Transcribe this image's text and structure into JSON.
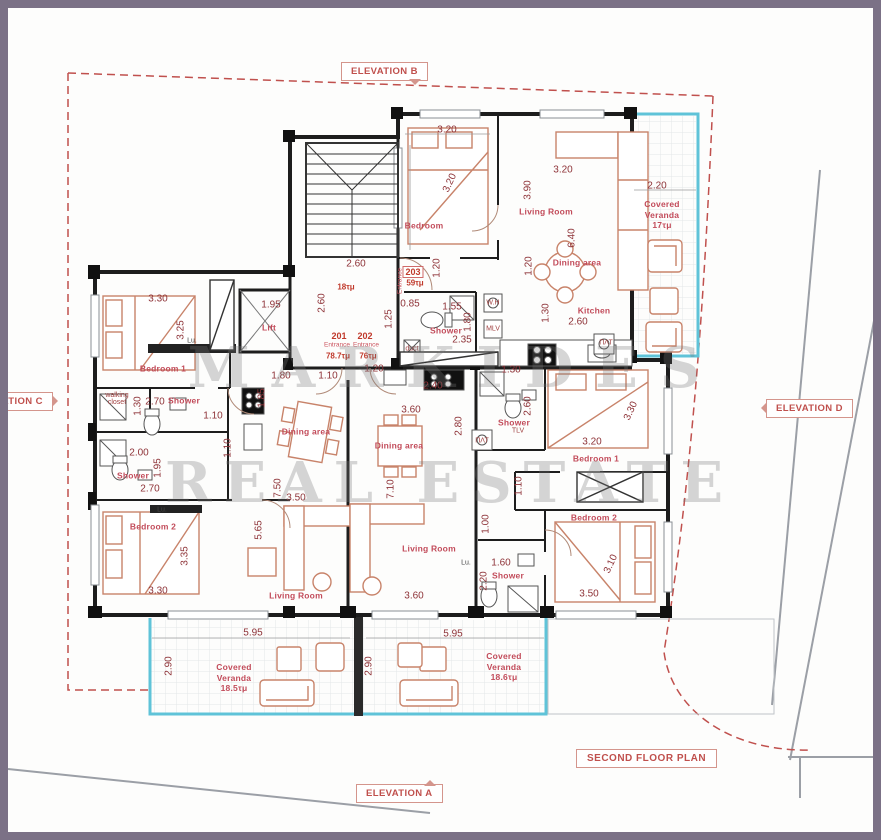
{
  "plan_title": "SECOND FLOOR PLAN",
  "elevations": {
    "a": "ELEVATION A",
    "b": "ELEVATION B",
    "c": "ELEVATION C",
    "d": "ELEVATION D"
  },
  "watermark": {
    "line1": "MARKIDES",
    "line2": "REAL ESTATE"
  },
  "units": {
    "u201": {
      "number": "201",
      "entrance": "Entrance",
      "area": "78.7τμ"
    },
    "u202": {
      "number": "202",
      "entrance": "Entrance",
      "area": "76τμ"
    },
    "u203": {
      "number": "203",
      "entrance": "Entrance",
      "area": "59τμ"
    },
    "landing_area": "18τμ"
  },
  "rooms": [
    "Bedroom",
    "Living Room",
    "Dining area",
    "Kitchen",
    "Covered\nVeranda\n17τμ",
    "Shower",
    "Lift",
    "Bedroom 1",
    "Shower",
    "Shower",
    "Bedroom 2",
    "Living Room",
    "Dining area",
    "Dining area",
    "Living Room",
    "Bedroom 1",
    "Shower",
    "Bedroom 2",
    "Shower",
    "Covered\nVeranda\n18.5τμ",
    "Covered\nVeranda\n18.6τμ"
  ],
  "dims": [
    "3.20",
    "3.20",
    "3.20",
    "3.90",
    "6.40",
    "2.20",
    "1.20",
    "1.30",
    "2.60",
    "0.85",
    "1.25",
    "1.55",
    "1.80",
    "2.35",
    "1.20",
    "2.60",
    "2.60",
    "1.95",
    "1.85",
    "1.10",
    "3.30",
    "3.25",
    "2.70",
    "1.30",
    "2.00",
    "1.95",
    "2.70",
    "1.10",
    "3.35",
    "3.30",
    "5.65",
    "7.50",
    "3.50",
    "1.80",
    "1.10",
    "1.20",
    "2.40",
    "3.60",
    "2.80",
    "7.10",
    "3.60",
    "1.30",
    "2.60",
    "3.30",
    "3.20",
    "1.10",
    "1.00",
    "1.60",
    "2.20",
    "3.10",
    "3.50",
    "5.95",
    "2.90",
    "2.90",
    "5.95"
  ],
  "small_labels": [
    "ΠΛΤ",
    "duct",
    "W.H",
    "MLV",
    "TLV",
    "ΠΛΤ",
    "Lu.",
    "Lu.",
    "Lu.",
    "walking\ncloset"
  ],
  "colors": {
    "frame": "#7b7186",
    "wall": "#1d1d1d",
    "annotation_red": "#c0504d",
    "furniture": "#c8836a",
    "veranda_edge": "#5fc3d8"
  }
}
